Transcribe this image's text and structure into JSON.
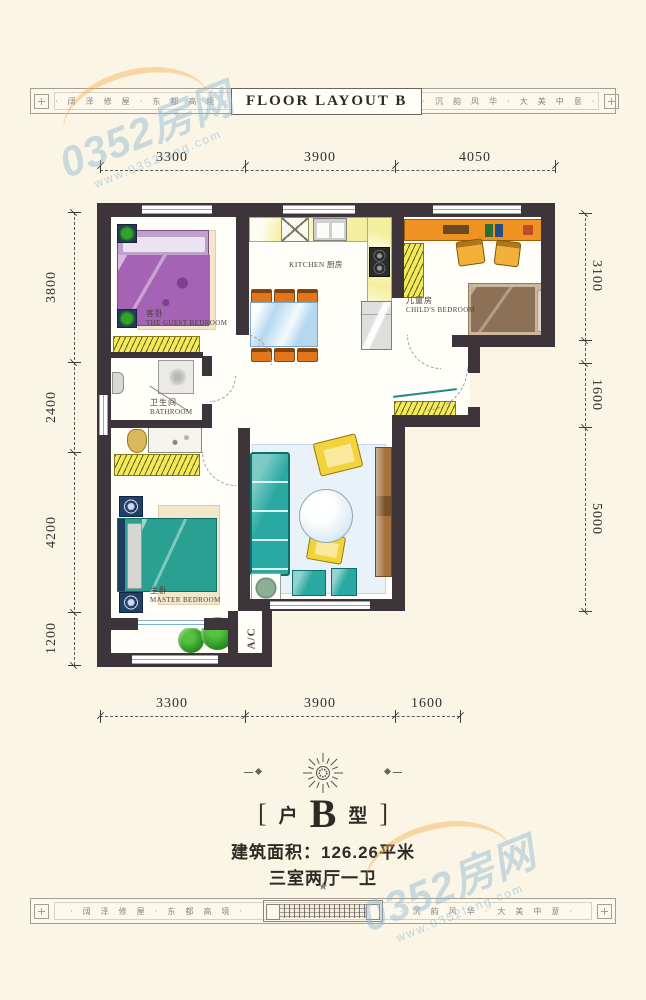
{
  "page": {
    "background": "#fbf5e6"
  },
  "header_band": {
    "title": "FLOOR LAYOUT B",
    "left_text": "· 阔 泽 修 屋 · 东 都 高 境 ·",
    "right_text": "· 沉 韵 风 华 · 大 美 中 意 ·"
  },
  "footer_band": {
    "left_text": "· 阔 泽 修 屋 · 东 都 高 境 ·",
    "right_text": "· 沉 韵 风 华 · 大 美 中 意 ·"
  },
  "watermark": {
    "brand": "0352房网",
    "url": "www.0352fang.com"
  },
  "dims": {
    "top": [
      "3300",
      "3900",
      "4050"
    ],
    "bottom": [
      "3300",
      "3900",
      "1600"
    ],
    "left": [
      "3800",
      "2400",
      "4200",
      "1200"
    ],
    "right": [
      "3100",
      "1600",
      "5000"
    ]
  },
  "rooms": {
    "kitchen": "KITCHEN 厨房",
    "guest_cn": "客卧",
    "guest_en": "THE GUEST BEDROOM",
    "bath_cn": "卫生间",
    "bath_en": "BATHROOM",
    "child_cn": "儿童房",
    "child_en": "CHILD'S BEDROOM",
    "master_cn": "主卧",
    "master_en": "MASTER BEDROOM",
    "ac": "A/C"
  },
  "info": {
    "bracket_left": "[",
    "type_cn": "户",
    "type_letter": "B",
    "type_cn2": "型",
    "bracket_right": "]",
    "area": "建筑面积：126.26平米",
    "rooms_desc": "三室两厅一卫",
    "star": "★"
  },
  "colors": {
    "wall": "#3d3539",
    "accent_yellow": "#f2ea58",
    "accent_teal": "#29a9a1",
    "accent_purple": "#a563b5",
    "accent_orange": "#e8891f",
    "watermark_blue": "#8ab9d4",
    "watermark_orange": "#f4b254"
  }
}
